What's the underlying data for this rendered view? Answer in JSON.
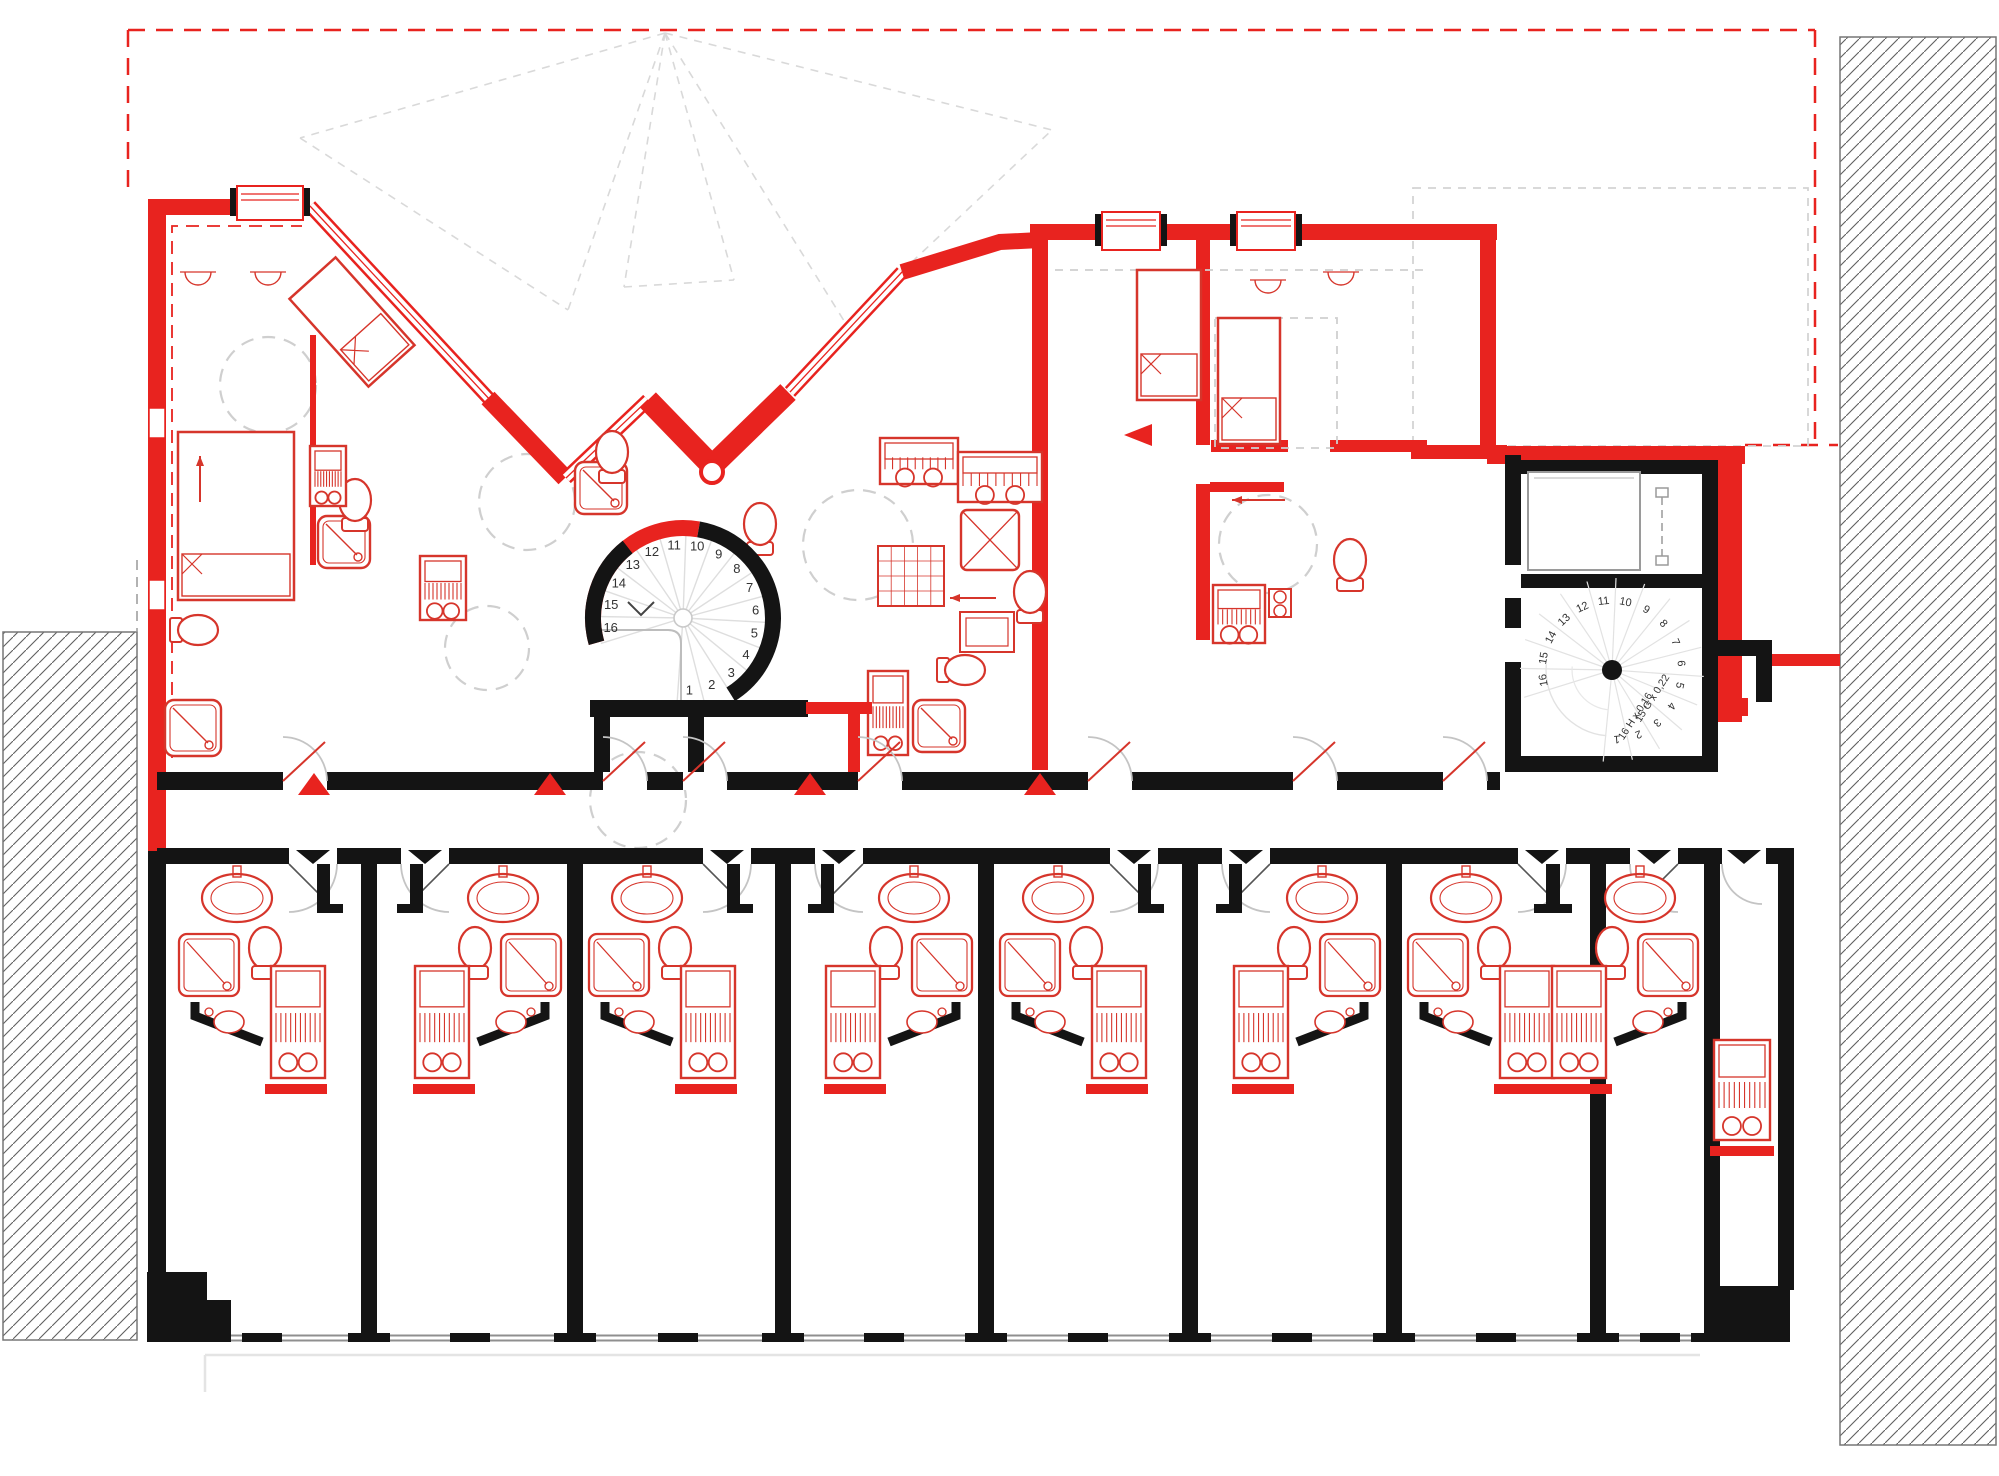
{
  "title": "Attic floor plan with studio units",
  "colors": {
    "wall_red": "#e8231f",
    "wall_black": "#141414",
    "fixture_red": "#d6352b",
    "dash_gray": "#cfcfcf",
    "roof_gray": "#d9d9d9",
    "window_gray": "#8f8f8f",
    "hatch_line": "#5f5f5f",
    "door_gray": "#c4c4c4"
  },
  "stairs": {
    "main_spiral": {
      "label": "spiral-staircase-main",
      "step_count": 16,
      "step_numbers": [
        "1",
        "2",
        "3",
        "4",
        "5",
        "6",
        "7",
        "8",
        "9",
        "10",
        "11",
        "12",
        "13",
        "14",
        "15",
        "16"
      ]
    },
    "secondary_spiral": {
      "label": "spiral-staircase-secondary",
      "step_count": 16,
      "step_numbers": [
        "1",
        "2",
        "3",
        "4",
        "5",
        "6",
        "7",
        "8",
        "9",
        "10",
        "11",
        "12",
        "13",
        "14",
        "15",
        "16"
      ],
      "annotations": [
        "15 G x 0,22",
        "16 H x 0,16"
      ]
    }
  },
  "corridor": {
    "entrance_marker_count": 4,
    "entrance_marker_xs": [
      314,
      550,
      810,
      1040
    ]
  },
  "lower_units": [
    {
      "id": "studio-1",
      "orientation": "L"
    },
    {
      "id": "studio-2",
      "orientation": "R"
    },
    {
      "id": "studio-3",
      "orientation": "L"
    },
    {
      "id": "studio-4",
      "orientation": "R"
    },
    {
      "id": "studio-5",
      "orientation": "L"
    },
    {
      "id": "studio-6",
      "orientation": "R"
    },
    {
      "id": "studio-7",
      "orientation": "L"
    },
    {
      "id": "studio-8",
      "orientation": "R"
    }
  ],
  "right_room": {
    "id": "studio-9",
    "orientation": "R"
  },
  "neighbors": {
    "left": "existing-building-hatched",
    "right": "existing-building-hatched"
  }
}
